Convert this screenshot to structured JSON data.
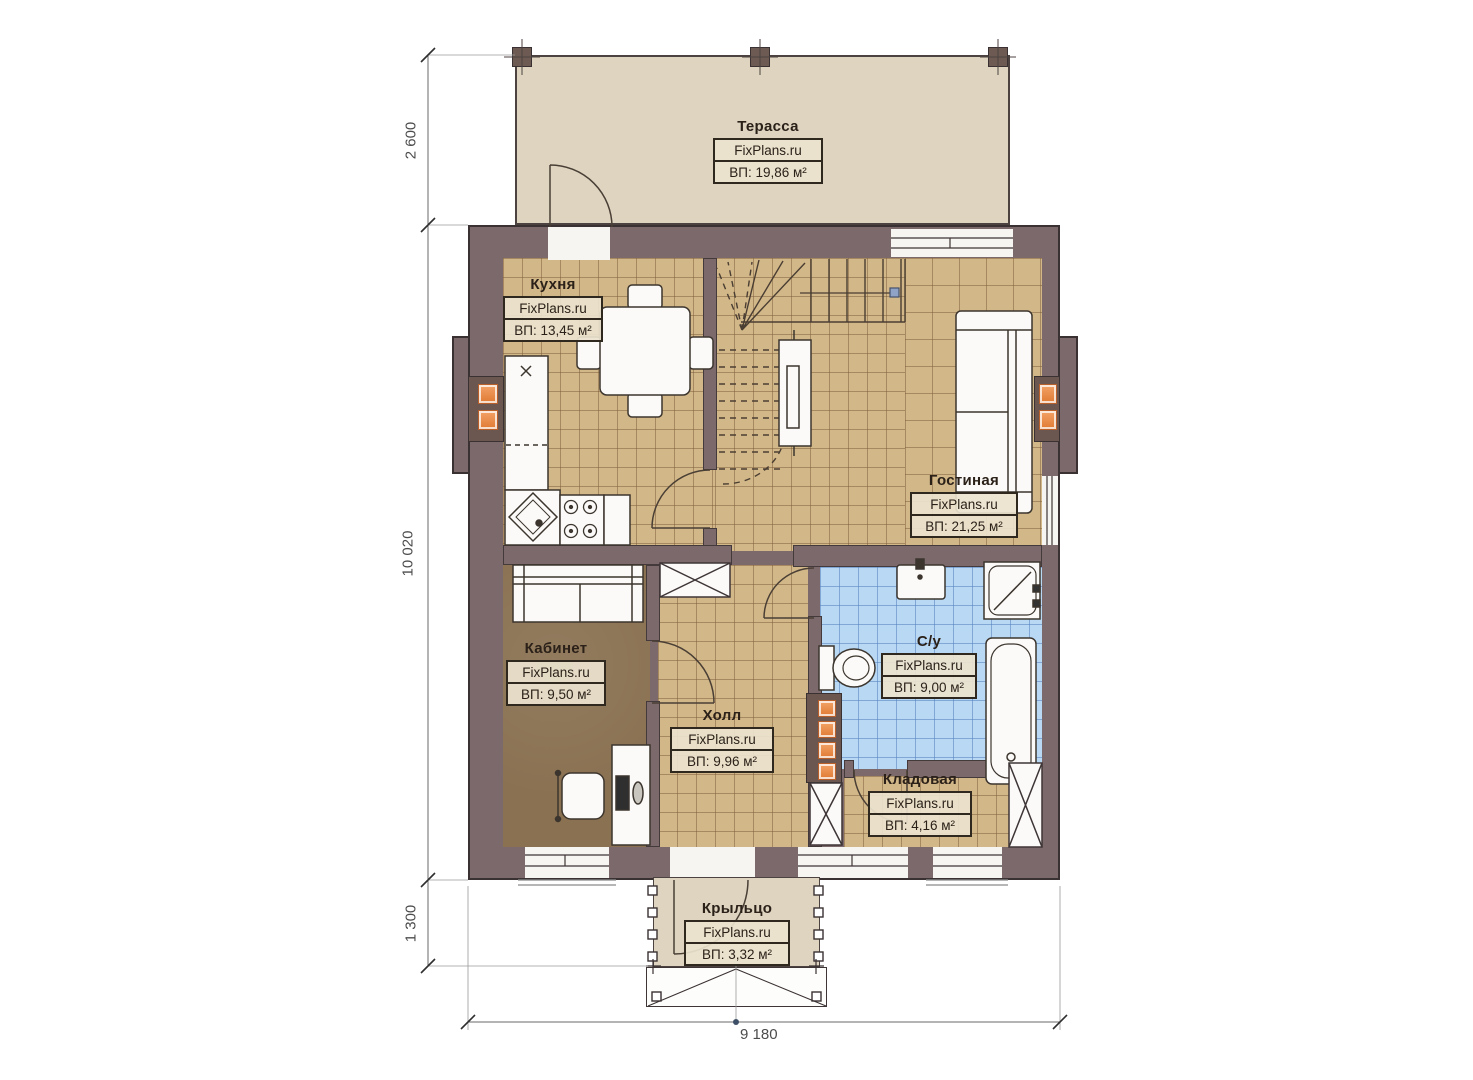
{
  "plan": {
    "brand": "FixPlans.ru",
    "rooms": [
      {
        "key": "terrace",
        "name": "Терасса",
        "area": "ВП: 19,86 м²"
      },
      {
        "key": "kitchen",
        "name": "Кухня",
        "area": "ВП: 13,45 м²"
      },
      {
        "key": "living",
        "name": "Гостиная",
        "area": "ВП: 21,25 м²"
      },
      {
        "key": "office",
        "name": "Кабинет",
        "area": "ВП: 9,50 м²"
      },
      {
        "key": "hall",
        "name": "Холл",
        "area": "ВП: 9,96 м²"
      },
      {
        "key": "bathroom",
        "name": "С/у",
        "area": "ВП: 9,00 м²"
      },
      {
        "key": "storage",
        "name": "Кладовая",
        "area": "ВП: 4,16 м²"
      },
      {
        "key": "porch",
        "name": "Крыльцо",
        "area": "ВП: 3,32 м²"
      }
    ],
    "dimensions": {
      "left_top": "2 600",
      "left_middle": "10 020",
      "left_bottom": "1 300",
      "bottom": "9 180"
    },
    "colors": {
      "wall": "#7c696b",
      "floor_tile": "#d2b788",
      "floor_office": "#8a7152",
      "floor_bath": "#b9d8f3",
      "terrace": "#ded4c0",
      "radiator": "#e07a33"
    }
  }
}
